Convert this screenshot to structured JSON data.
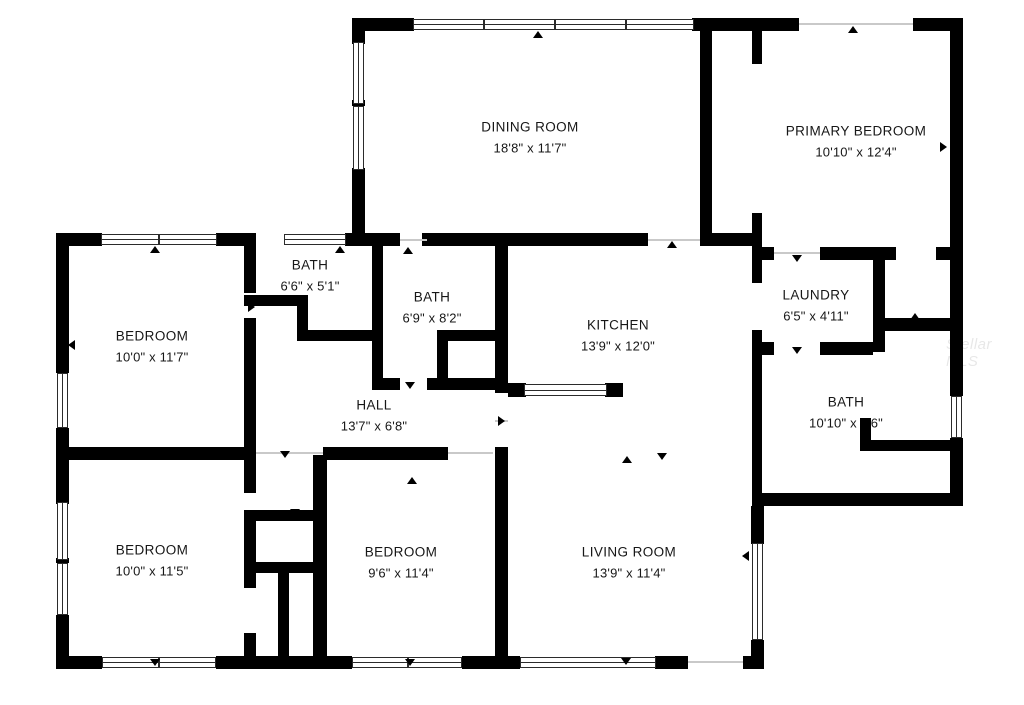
{
  "watermark": "Stellar MLS",
  "rooms": {
    "dining_room": {
      "name": "DINING ROOM",
      "dims": "18'8\" x 11'7\""
    },
    "primary_bedroom": {
      "name": "PRIMARY BEDROOM",
      "dims": "10'10\" x 12'4\""
    },
    "bath_small": {
      "name": "BATH",
      "dims": "6'6\" x 5'1\""
    },
    "bath_middle": {
      "name": "BATH",
      "dims": "6'9\" x 8'2\""
    },
    "bedroom_left": {
      "name": "BEDROOM",
      "dims": "10'0\" x 11'7\""
    },
    "kitchen": {
      "name": "KITCHEN",
      "dims": "13'9\" x 12'0\""
    },
    "laundry": {
      "name": "LAUNDRY",
      "dims": "6'5\" x 4'11\""
    },
    "bath_right": {
      "name": "BATH",
      "dims": "10'10\" x 9'6\""
    },
    "hall": {
      "name": "HALL",
      "dims": "13'7\" x 6'8\""
    },
    "bedroom_bottom_left": {
      "name": "BEDROOM",
      "dims": "10'0\" x 11'5\""
    },
    "bedroom_bottom_mid": {
      "name": "BEDROOM",
      "dims": "9'6\" x 11'4\""
    },
    "living_room": {
      "name": "LIVING ROOM",
      "dims": "13'9\" x 11'4\""
    }
  }
}
